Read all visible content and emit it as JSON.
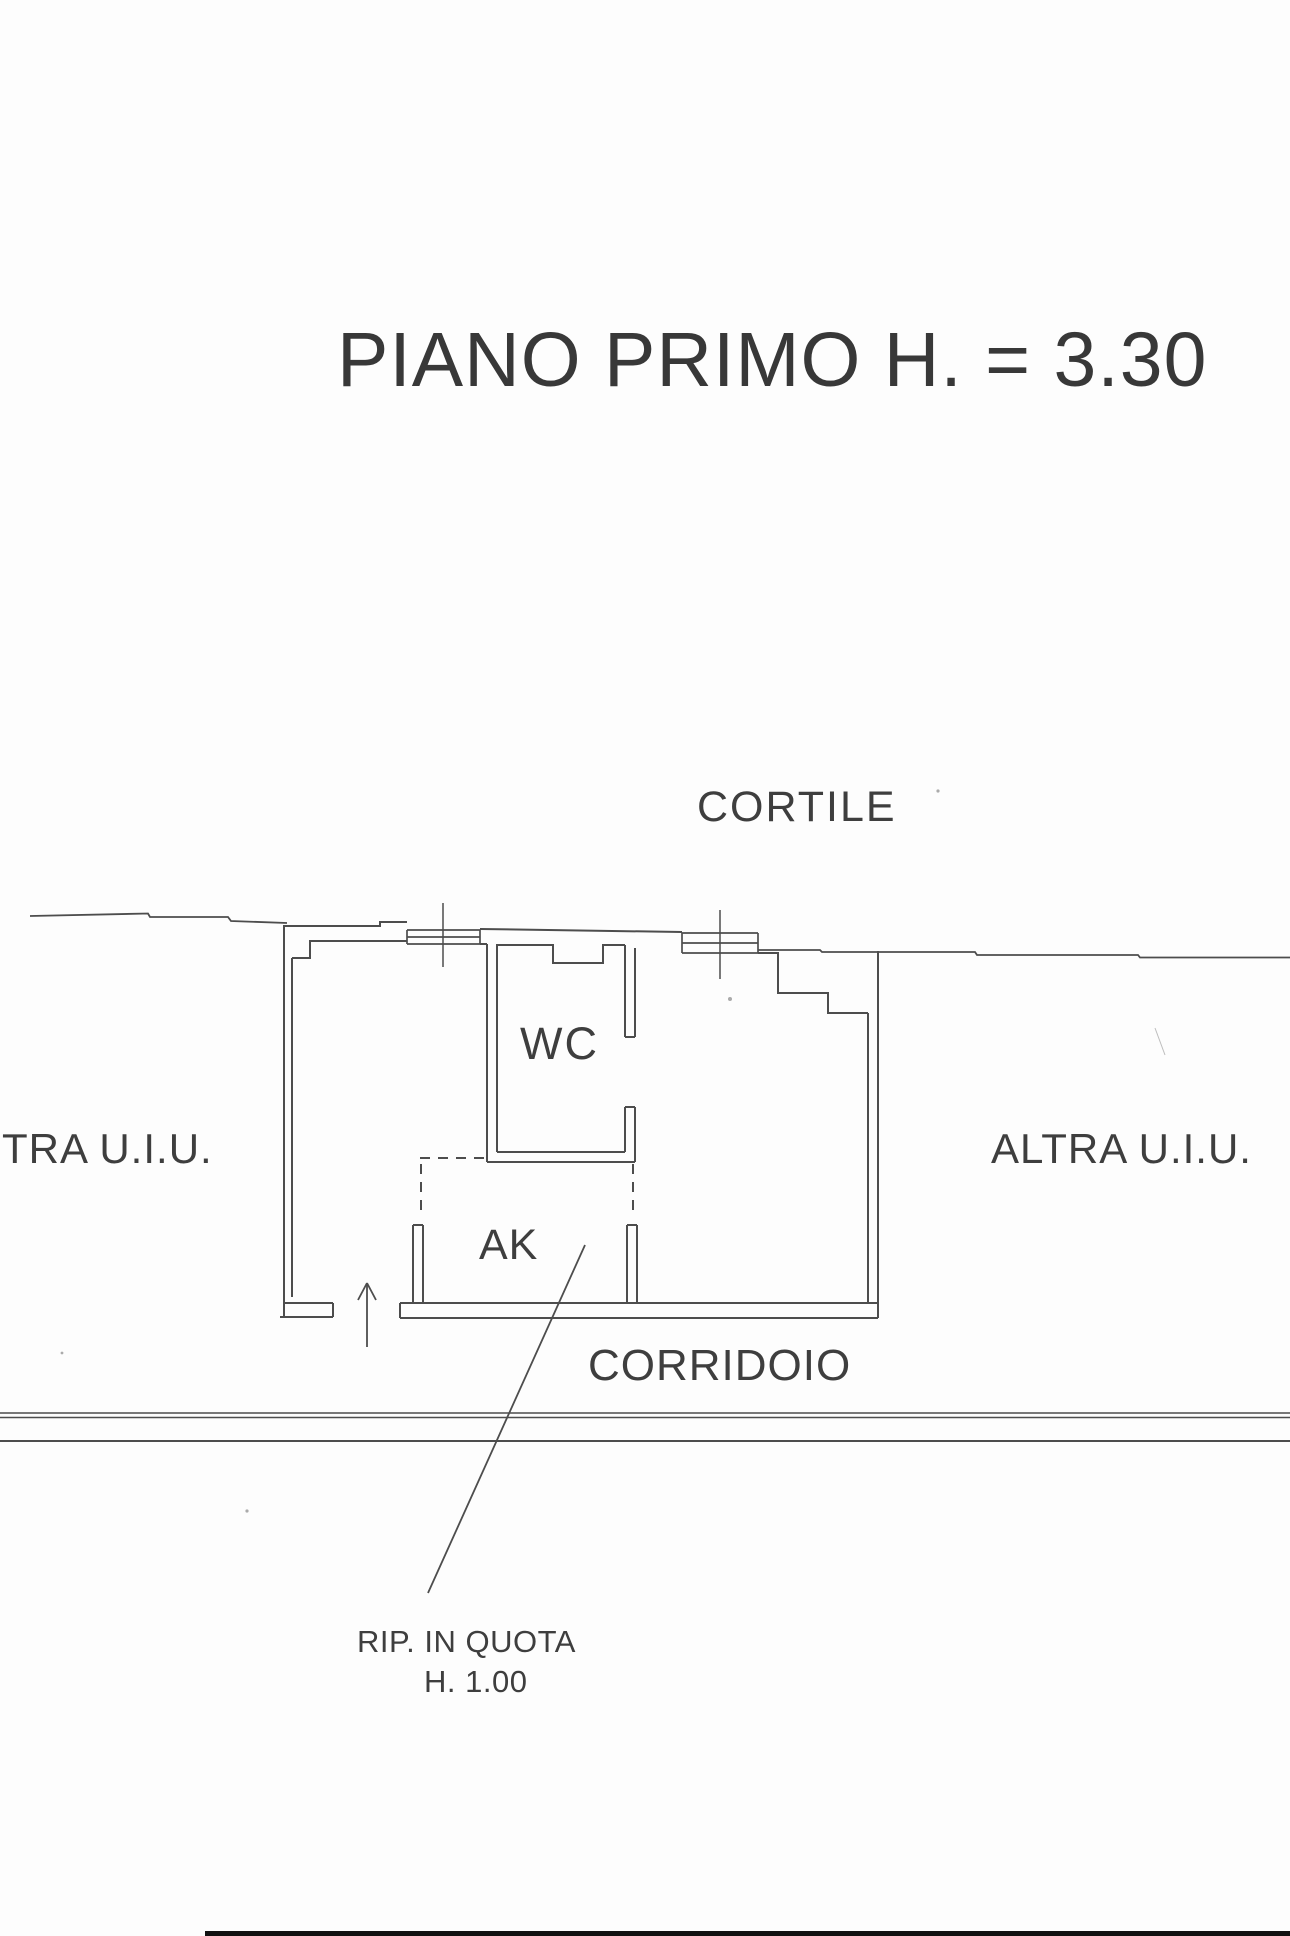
{
  "document": {
    "type": "scanned floor plan (planimetria catastale)",
    "title": "PIANO PRIMO H. = 3.30"
  },
  "labels": {
    "cortile": "CORTILE",
    "other_unit_left": "TRA U.I.U.",
    "other_unit_right": "ALTRA U.I.U.",
    "wc": "WC",
    "ak": "AK",
    "corridoio": "CORRIDOIO",
    "annotation_line1": "RIP. IN QUOTA",
    "annotation_line2": "H. 1.00"
  },
  "colors": {
    "paper": "#fdfdfd",
    "ink": "#4d4d4d",
    "text": "#3e3e3e",
    "scanner_edge": "#111111"
  }
}
